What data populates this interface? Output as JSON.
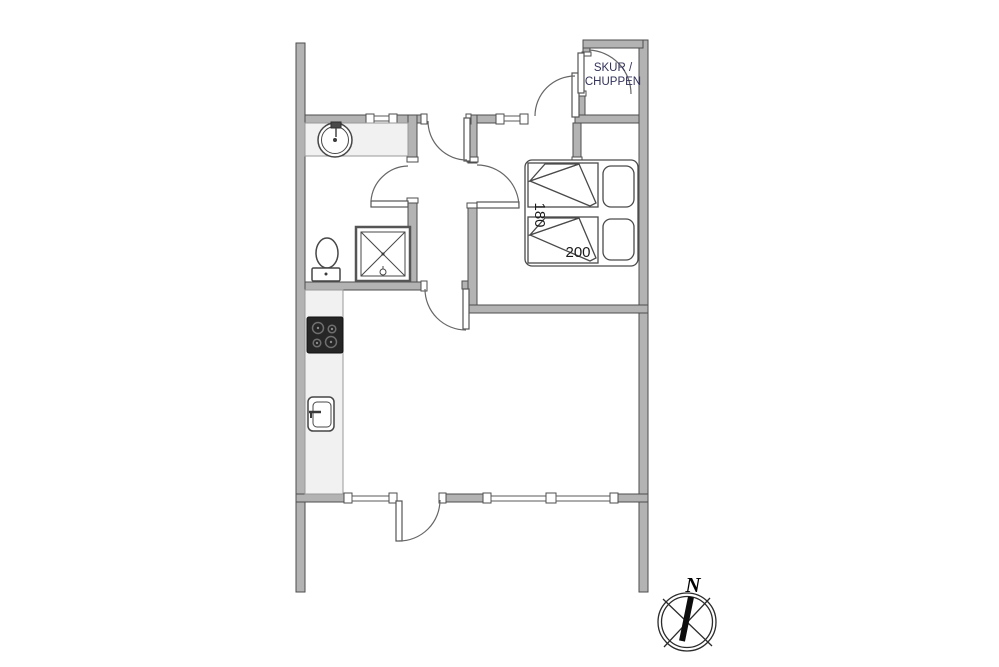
{
  "drawing": {
    "type": "floor-plan",
    "labels": {
      "shed_line1": "SKUR /",
      "shed_line2": "CHUPPEN",
      "bed_width_cm": "180",
      "bed_length_cm": "200",
      "compass_north": "N"
    },
    "rooms_depicted": {
      "shed": "SKUR / CHUPPEN",
      "bed_dimensions": [
        "180",
        "200"
      ]
    },
    "colors": {
      "background": "#ffffff",
      "wall_fill": "#b3b3b3",
      "wall_stroke": "#4e4e4e",
      "counter_fill": "#f1f1f1",
      "cooktop_fill": "#262626",
      "furniture_stroke": "#474747",
      "room_label_color": "#32325a",
      "dimension_color": "#1a1a1a",
      "compass_color": "#0d0d0d"
    }
  }
}
